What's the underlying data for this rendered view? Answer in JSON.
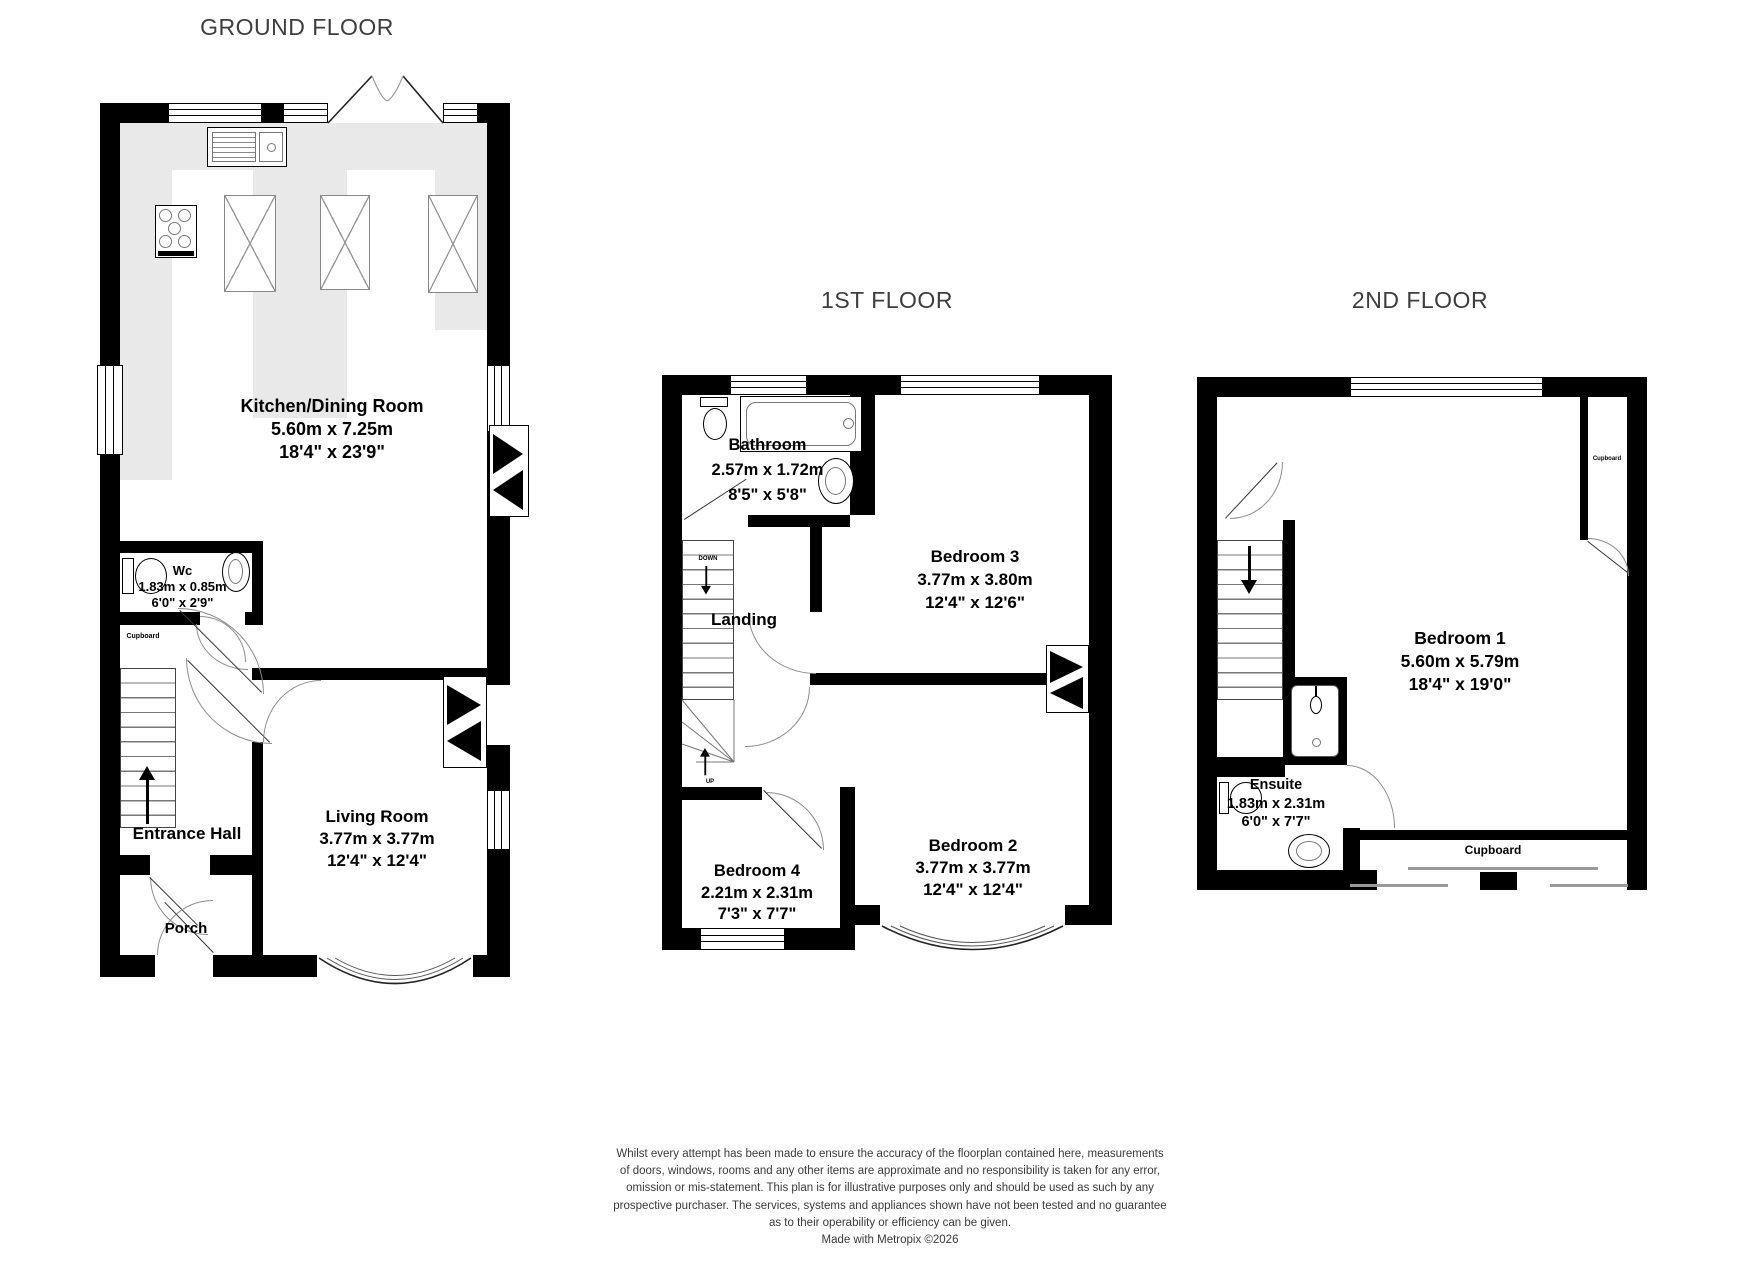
{
  "titles": {
    "ground": "GROUND FLOOR",
    "first": "1ST FLOOR",
    "second": "2ND FLOOR"
  },
  "rooms": {
    "kitchen": {
      "name": "Kitchen/Dining Room",
      "metric": "5.60m x 7.25m",
      "imperial": "18'4\" x 23'9\""
    },
    "wc": {
      "name": "Wc",
      "metric": "1.83m x 0.85m",
      "imperial": "6'0\" x 2'9\""
    },
    "cupboard_ground": {
      "name": "Cupboard"
    },
    "entrance_hall": {
      "name": "Entrance Hall"
    },
    "living_room": {
      "name": "Living Room",
      "metric": "3.77m x 3.77m",
      "imperial": "12'4\" x 12'4\""
    },
    "porch": {
      "name": "Porch"
    },
    "bathroom": {
      "name": "Bathroom",
      "metric": "2.57m x 1.72m",
      "imperial": "8'5\" x 5'8\""
    },
    "landing": {
      "name": "Landing"
    },
    "bedroom3": {
      "name": "Bedroom 3",
      "metric": "3.77m x 3.80m",
      "imperial": "12'4\" x 12'6\""
    },
    "bedroom4": {
      "name": "Bedroom 4",
      "metric": "2.21m x 2.31m",
      "imperial": "7'3\" x 7'7\""
    },
    "bedroom2": {
      "name": "Bedroom 2",
      "metric": "3.77m x 3.77m",
      "imperial": "12'4\" x 12'4\""
    },
    "bedroom1": {
      "name": "Bedroom 1",
      "metric": "5.60m x 5.79m",
      "imperial": "18'4\" x 19'0\""
    },
    "ensuite": {
      "name": "Ensuite",
      "metric": "1.83m x 2.31m",
      "imperial": "6'0\" x 7'7\""
    },
    "cupboard_second_side": {
      "name": "Cupboard"
    },
    "cupboard_second": {
      "name": "Cupboard"
    }
  },
  "stairs": {
    "down_label": "DOWN",
    "up_label": "UP"
  },
  "disclaimer": {
    "lines": [
      "Whilst every attempt has been made to ensure the accuracy of the floorplan contained here, measurements",
      "of doors, windows, rooms and any other items are approximate and no responsibility is taken for any error,",
      "omission or mis-statement. This plan is for illustrative purposes only and should be used as such by any",
      "prospective purchaser. The services, systems and appliances shown have not been tested and no guarantee",
      "as to their operability or efficiency can be given."
    ],
    "credit": "Made with Metropix ©2026"
  },
  "colors": {
    "wall": "#000000",
    "counter_fill": "#e9e9e9",
    "arc": "#8d8d8d",
    "title_text": "#3d3d3d",
    "disclaimer_text": "#3a3a3a"
  }
}
